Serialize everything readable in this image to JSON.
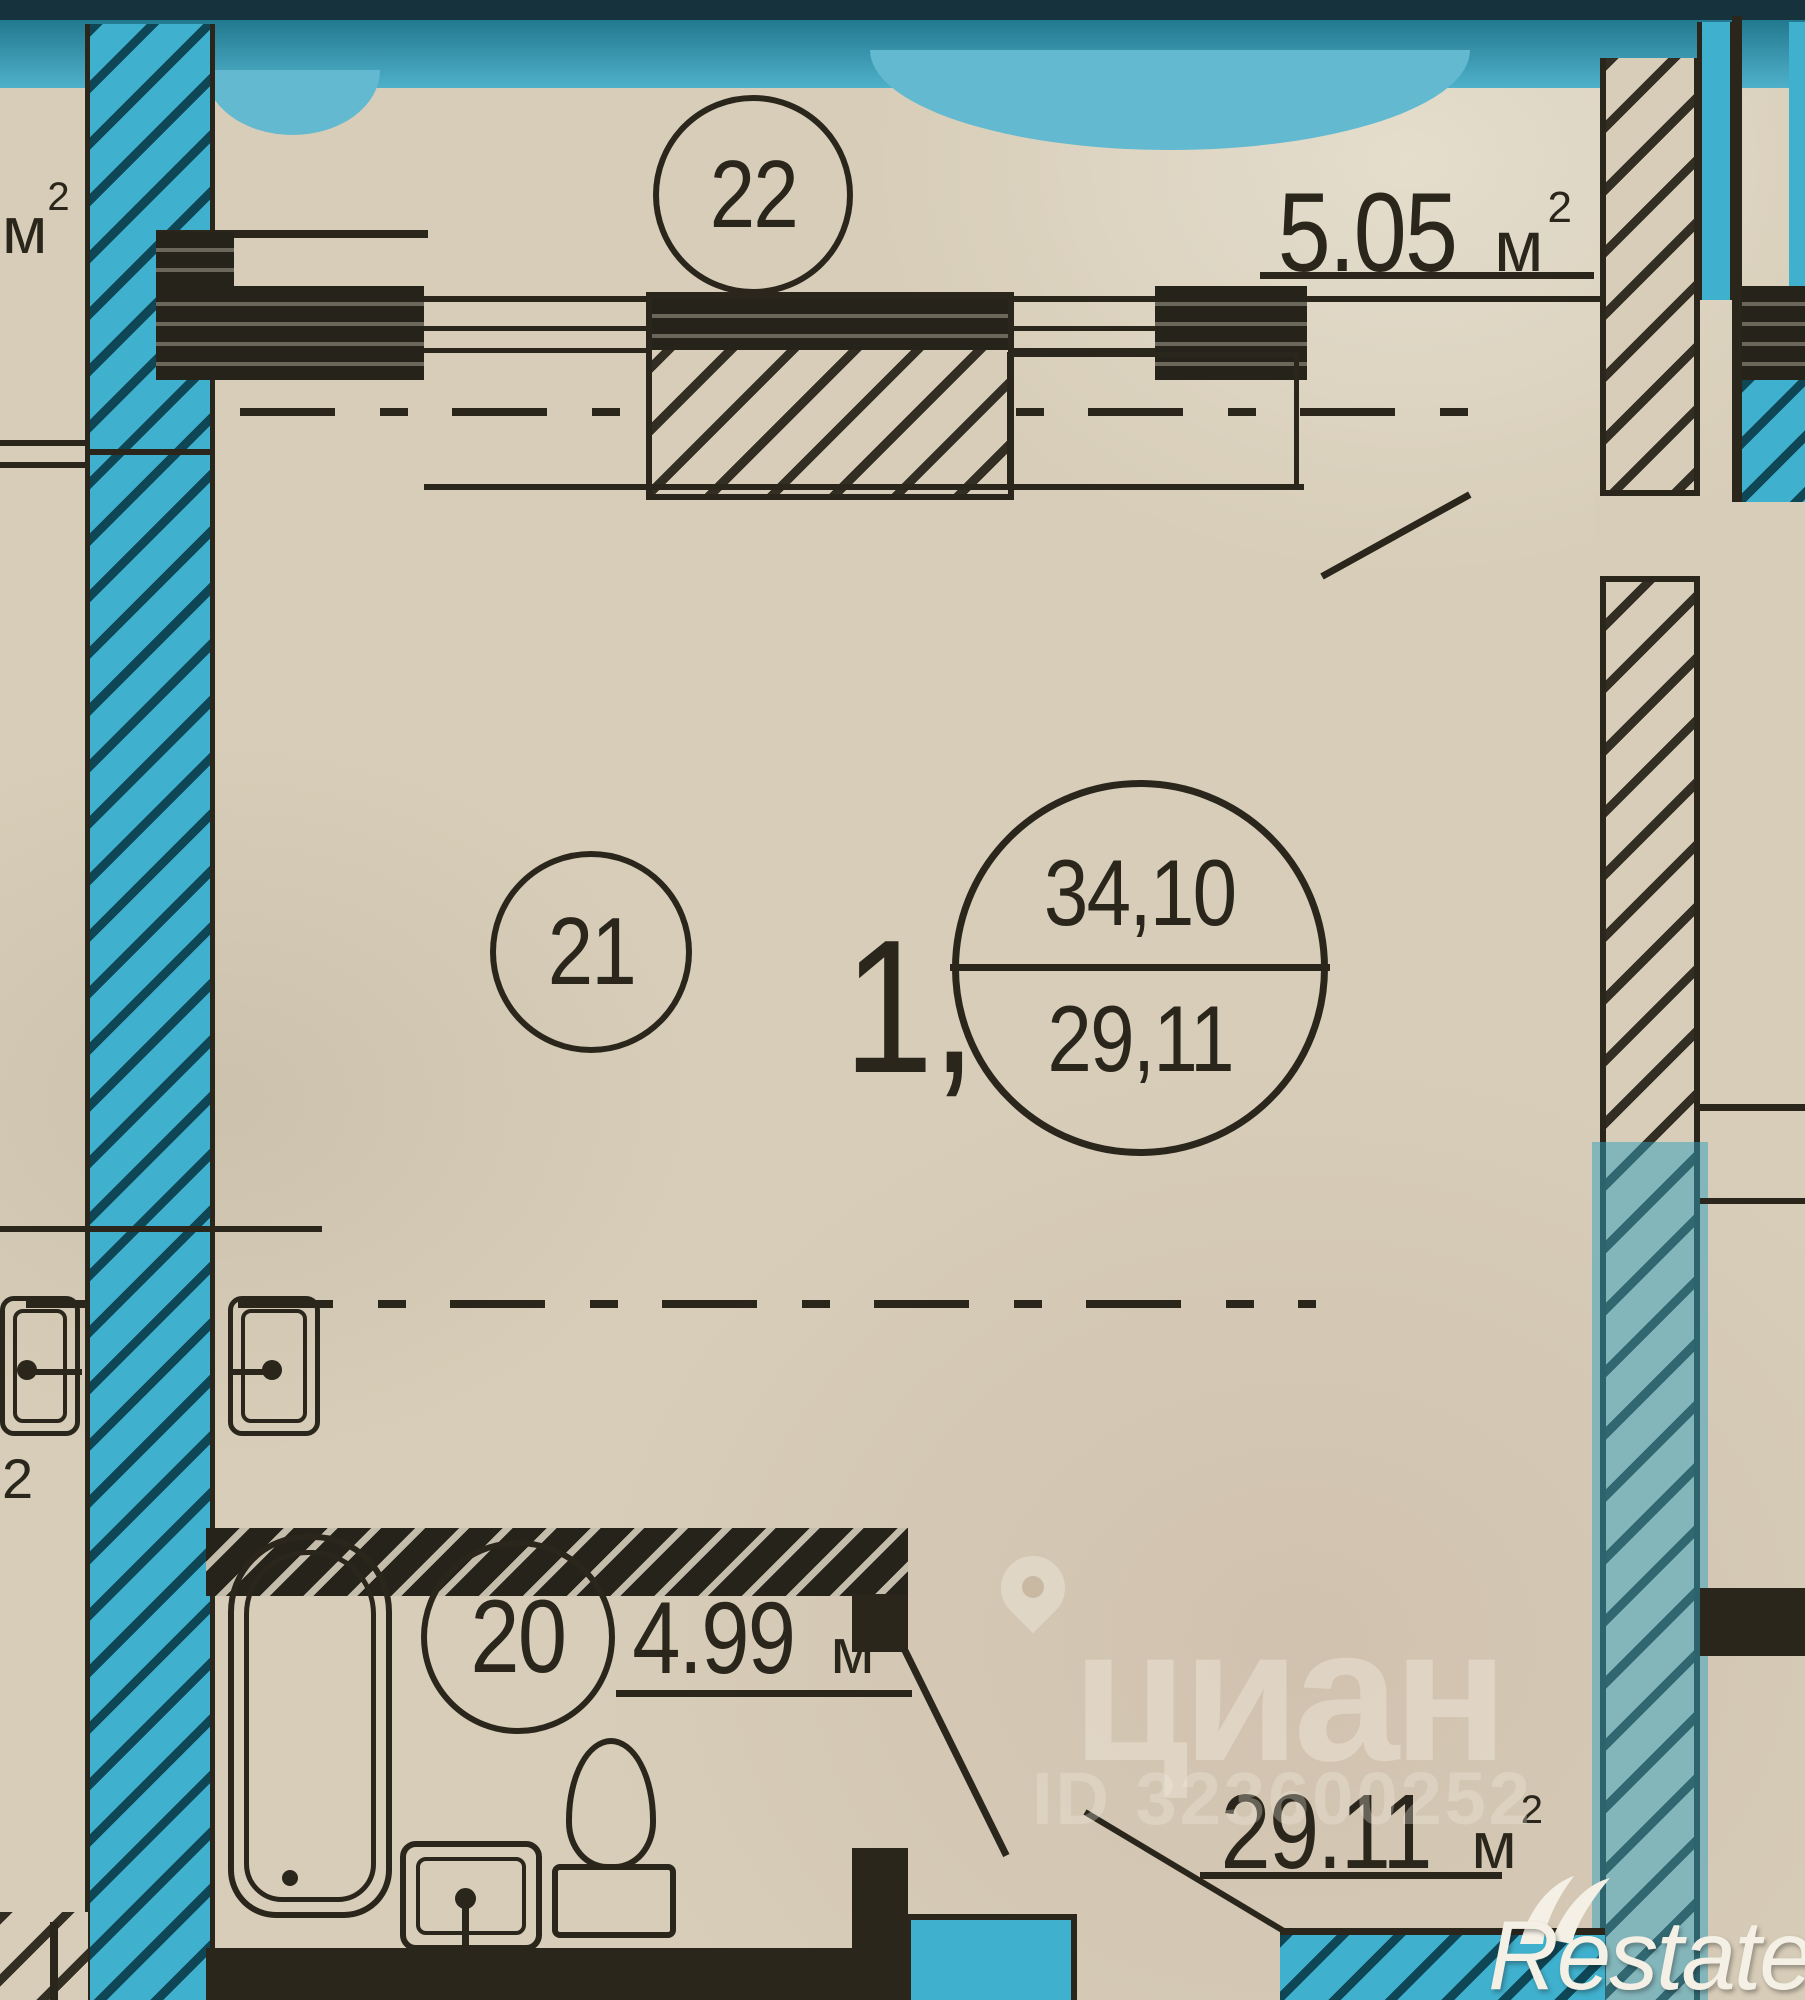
{
  "plan": {
    "rooms": {
      "balcony": {
        "number": "22",
        "area": "5.05"
      },
      "living": {
        "number": "21"
      },
      "bathroom": {
        "number": "20",
        "area": "4.99"
      },
      "hall": {
        "area": "29.11"
      }
    },
    "unit": {
      "prefix": "1,",
      "total_area": "34,10",
      "living_area": "29,11"
    },
    "area_unit": {
      "letter": "м",
      "sup": "2"
    },
    "edge_partials": {
      "top_left_letter": "м",
      "top_left_sup": "2",
      "bottom_left_sup": "2"
    }
  },
  "watermarks": {
    "cian": {
      "logo_text": "циан",
      "id_text": "ID 323600252"
    },
    "restate": {
      "logo_text": "Restate"
    }
  },
  "colors": {
    "paper": "#d7cdb8",
    "ink": "#2a261c",
    "highlight_teal": "#3fb0cd",
    "highlight_navy": "#16323c",
    "watermark_white": "#f2ecdf"
  }
}
